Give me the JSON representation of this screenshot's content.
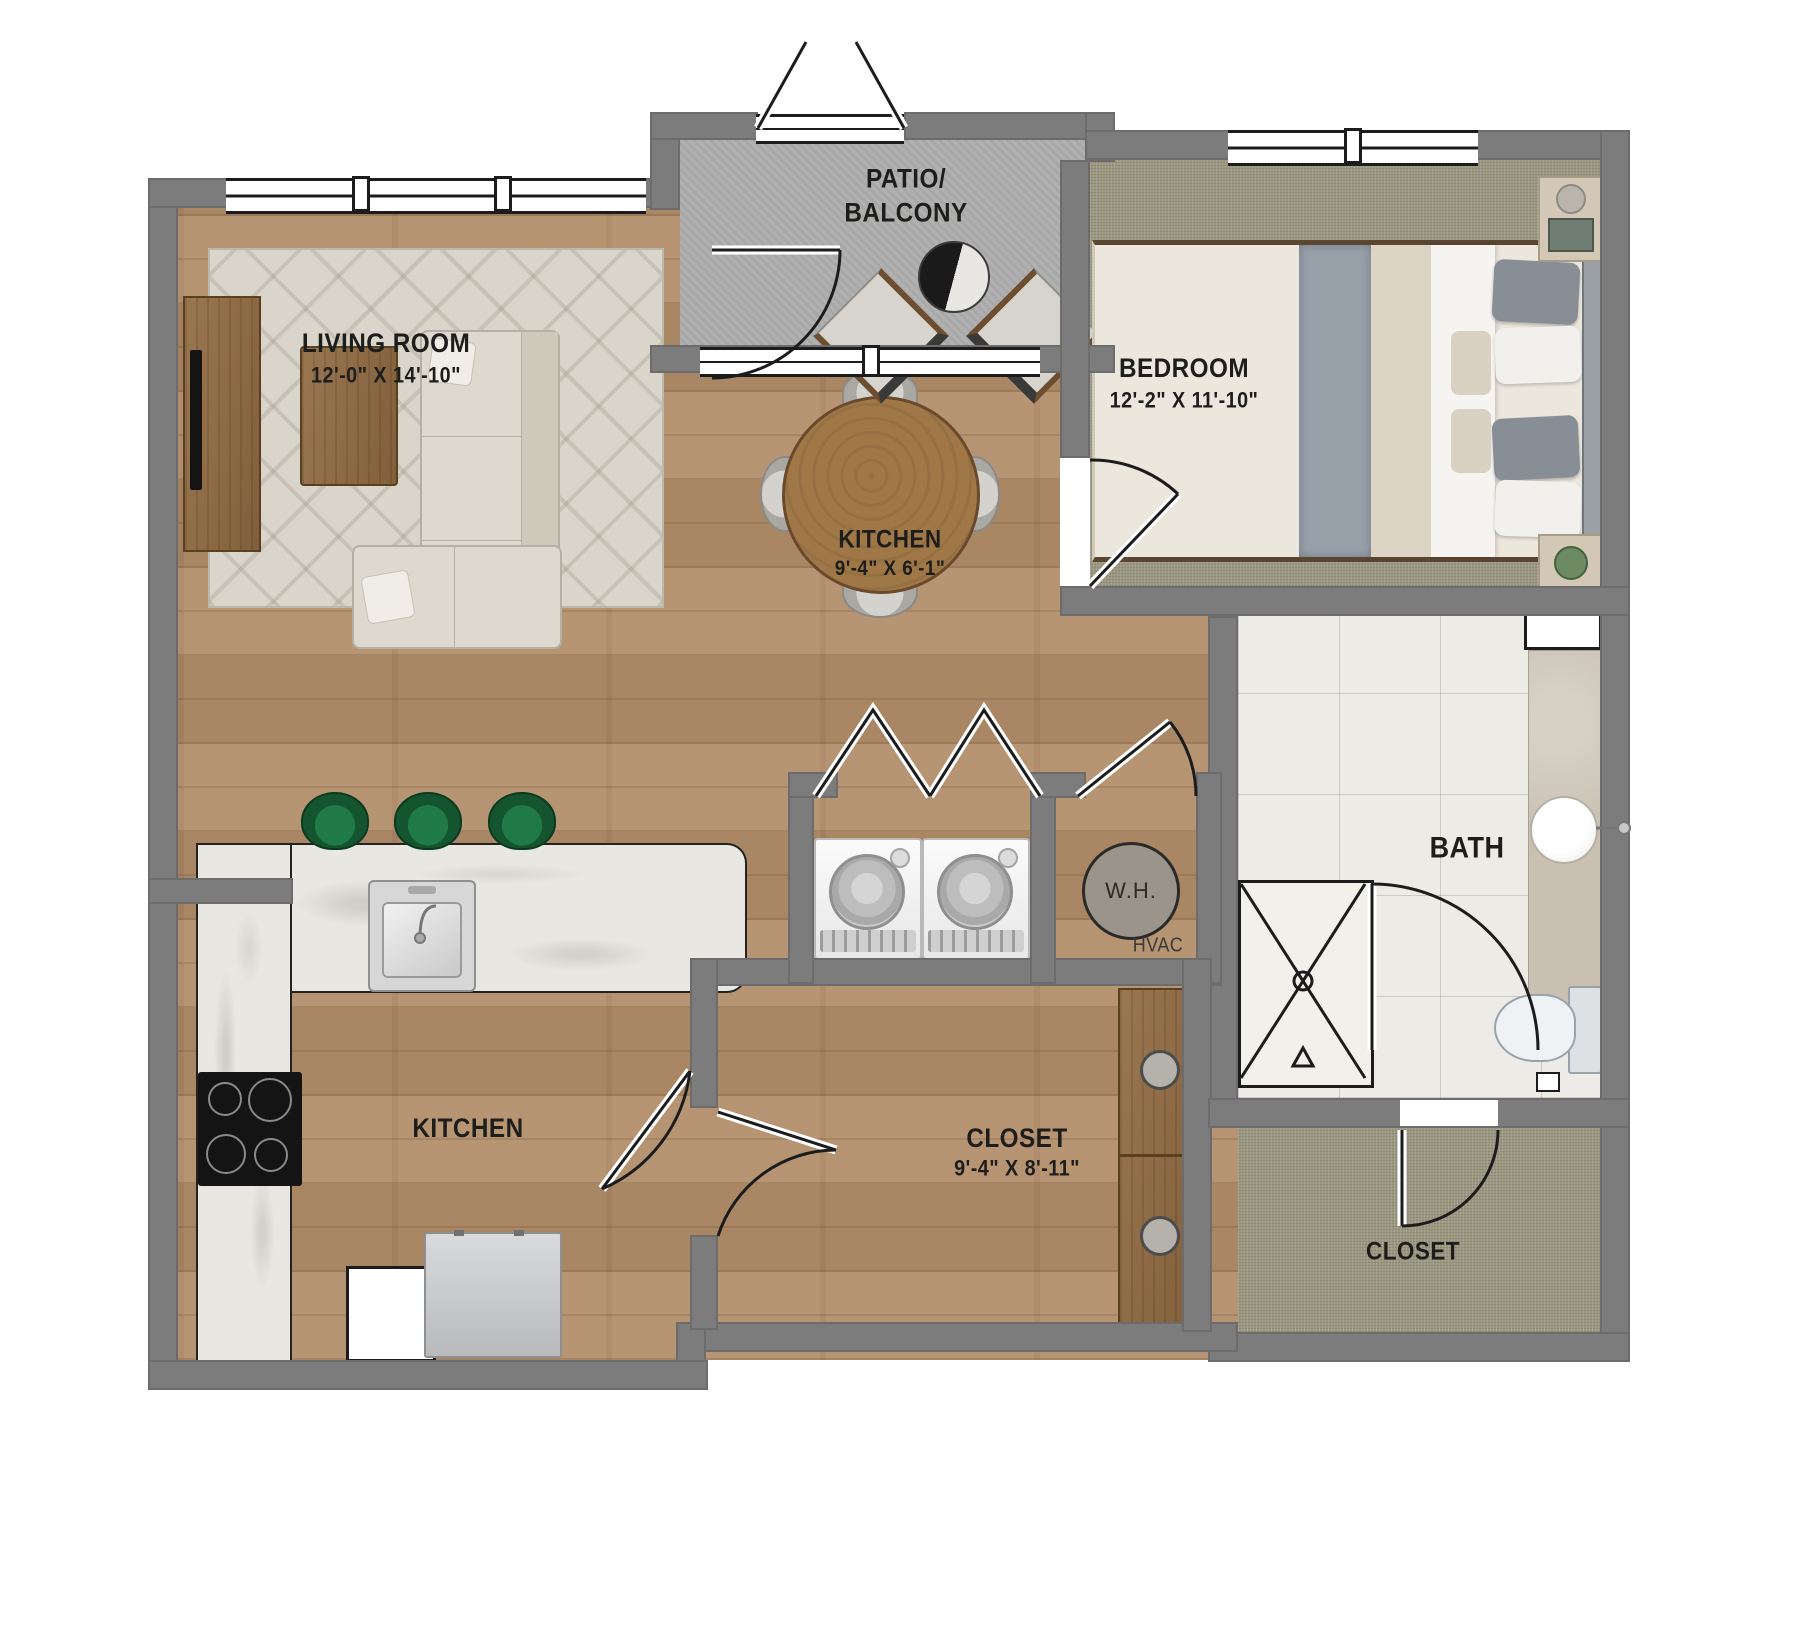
{
  "labels": {
    "living_room": {
      "name": "LIVING ROOM",
      "dims": "12'-0\" X 14'-10\""
    },
    "patio": {
      "name": "PATIO/\nBALCONY"
    },
    "bedroom": {
      "name": "BEDROOM",
      "dims": "12'-2\" X 11'-10\""
    },
    "dining": {
      "name": "KITCHEN",
      "dims": "9'-4\" X 6'-1\""
    },
    "kitchen": {
      "name": "KITCHEN"
    },
    "closet_main": {
      "name": "CLOSET",
      "dims": "9'-4\" X 8'-11\""
    },
    "bath": {
      "name": "BATH"
    },
    "closet_secondary": {
      "name": "CLOSET"
    },
    "water_heater": {
      "name": "W.H."
    },
    "hvac": {
      "name": "HVAC"
    }
  },
  "palette": {
    "wall_gray": "#7c7c7c",
    "wood_floor": "#b28e6a",
    "carpet": "#9a9781",
    "patio_concrete": "#adadad",
    "bath_tile": "#edebe5",
    "counter_marble": "#e9e7e1",
    "stool_green": "#1f7a47",
    "linework": "#1c1c1c"
  }
}
